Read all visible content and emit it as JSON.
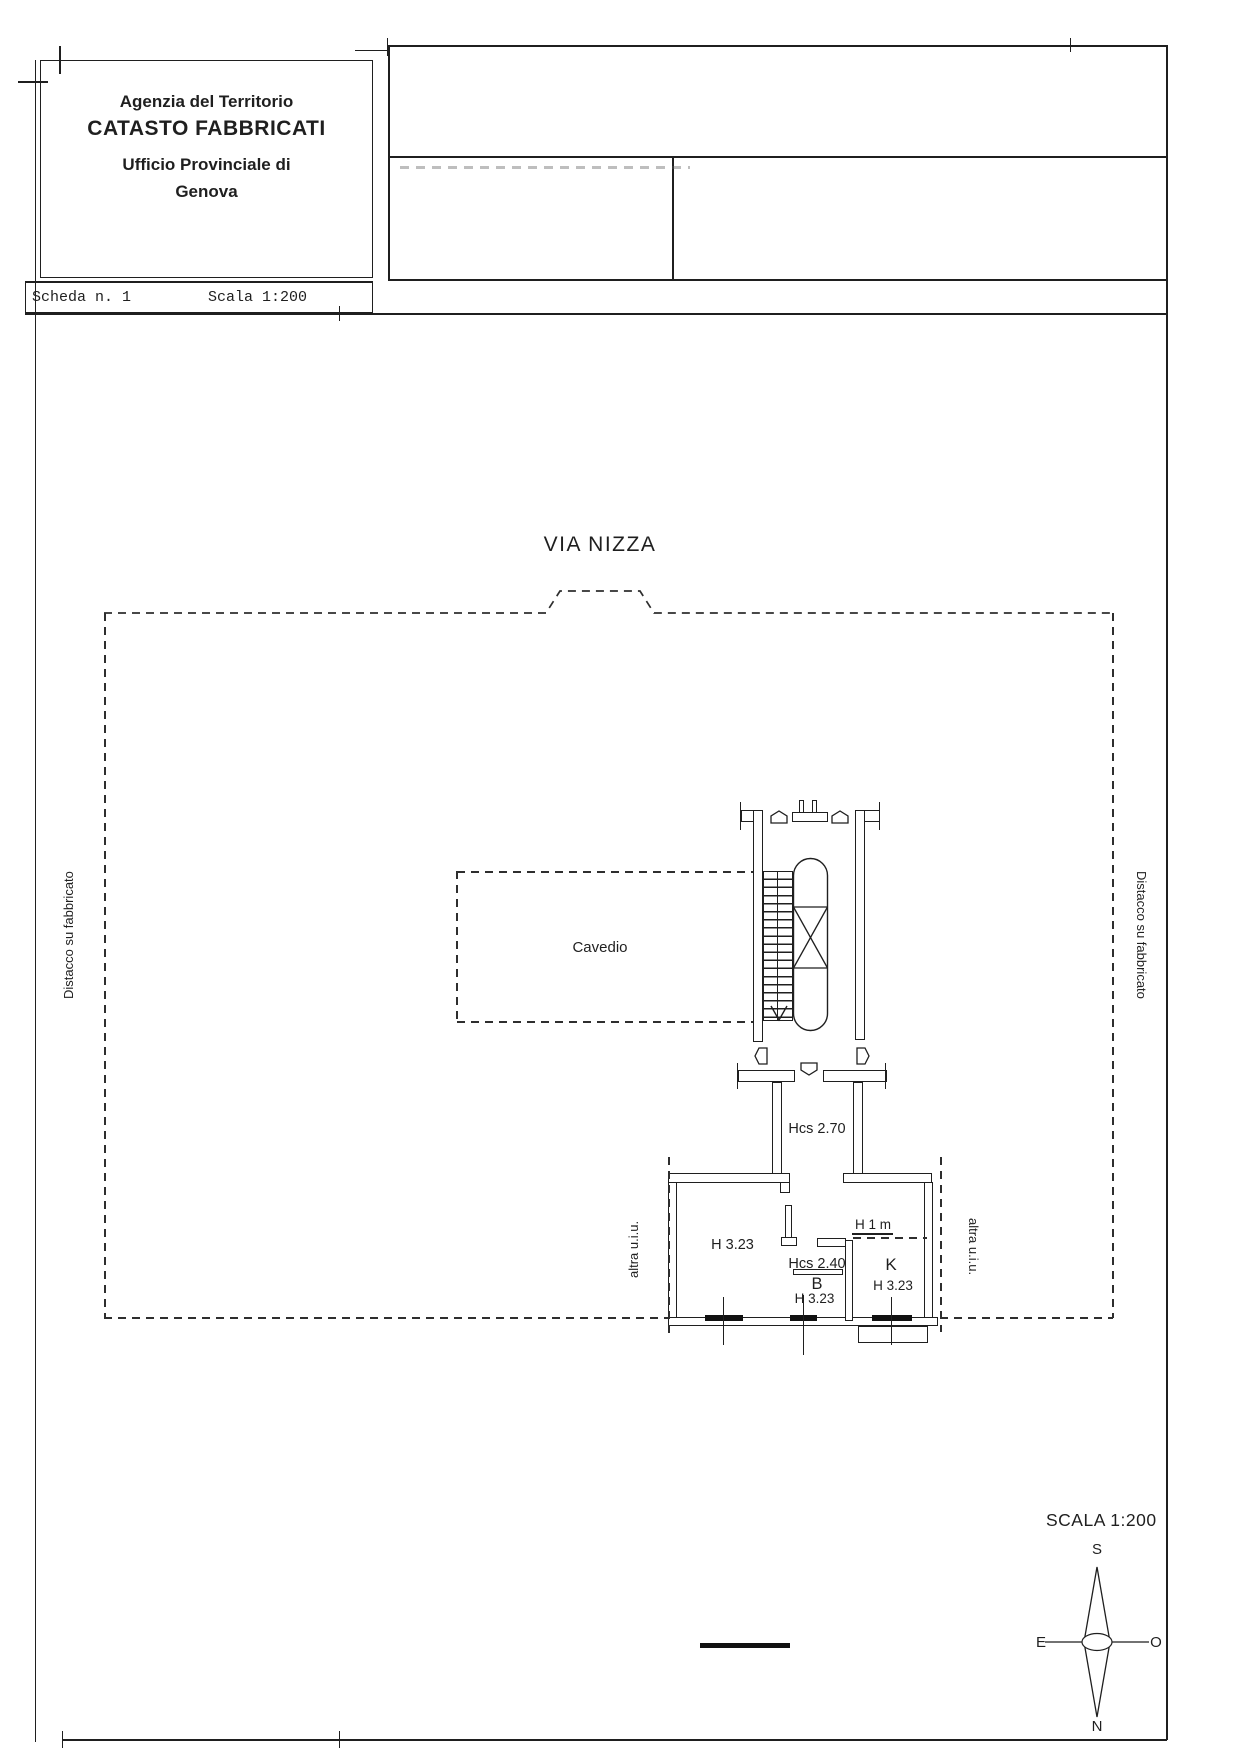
{
  "header": {
    "agency": "Agenzia del Territorio",
    "title": "CATASTO FABBRICATI",
    "office": "Ufficio Provinciale di",
    "city": "Genova"
  },
  "strip": {
    "sheet": "Scheda n. 1",
    "scale": "Scala 1:200"
  },
  "plan": {
    "street": "VIA NIZZA",
    "cavedio": "Cavedio",
    "hcs_corridor": "Hcs 2.70",
    "h_living": "H 3.23",
    "hcs_bath": "Hcs 2.40",
    "b_room": "B",
    "h_bath": "H 3.23",
    "k_room": "K",
    "h_kitchen": "H 3.23",
    "h_parapet": "H 1 m",
    "distacco_left": "Distacco su fabbricato",
    "distacco_right": "Distacco su fabbricato",
    "altra_left": "altra u.i.u.",
    "altra_right": "altra u.i.u."
  },
  "footer": {
    "scala": "SCALA 1:200",
    "compass": {
      "top": "S",
      "left": "E",
      "right": "O",
      "bottom": "N"
    }
  },
  "colors": {
    "line": "#1f1f1f",
    "dashed": "#2e2e2e",
    "paper": "#ffffff"
  }
}
